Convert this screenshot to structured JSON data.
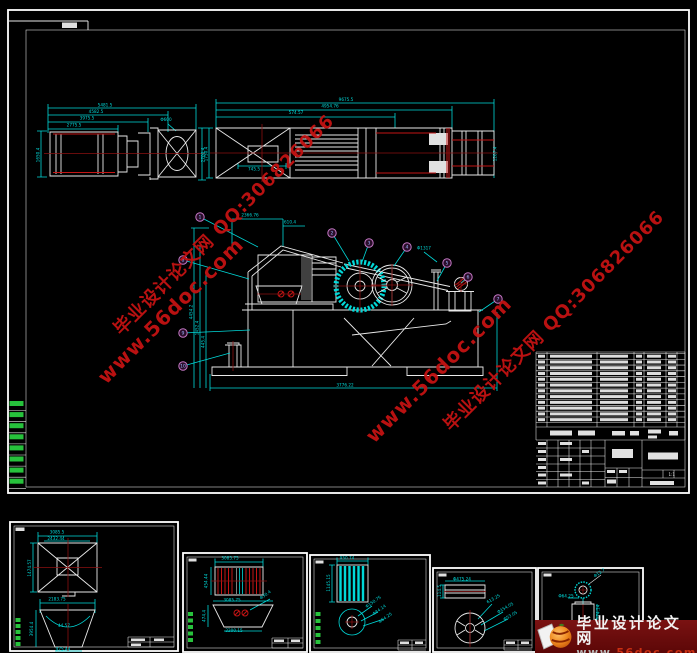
{
  "colors": {
    "cyan": "#00d9d9",
    "white": "#e9e9e9",
    "red": "#c41414",
    "dark_red": "#8a1010",
    "green": "#27c23c",
    "balloon": "#c678c6",
    "watermark": "#c31212",
    "logo_bg": "#6e0b0b",
    "logo_orange": "#e8791e"
  },
  "watermarks": {
    "line_zh_qq": "毕业设计论文网  QQ:306826066",
    "line_url": "www.56doc.com"
  },
  "logo": {
    "site_name": "毕业设计论文网",
    "url_www": "www.",
    "url_mid": "56doc",
    "url_dot": ".",
    "url_tld": "com"
  },
  "main_sheet": {
    "title_block": {
      "scale": "1:1"
    },
    "bom": {
      "rows": 12,
      "y0": 353.5,
      "step": 5.77,
      "cols": [
        {
          "x": 538,
          "w": 7
        },
        {
          "x": 550,
          "w": 42
        },
        {
          "x": 600,
          "w": 28
        },
        {
          "x": 636,
          "w": 6
        },
        {
          "x": 647,
          "w": 14
        },
        {
          "x": 668,
          "w": 8
        }
      ]
    },
    "balloons": [
      {
        "n": "1",
        "x": 200,
        "y": 217,
        "tx": 258,
        "ty": 247
      },
      {
        "n": "2",
        "x": 332,
        "y": 233,
        "tx": 349,
        "ty": 261
      },
      {
        "n": "3",
        "x": 369,
        "y": 243,
        "tx": 362,
        "ty": 262
      },
      {
        "n": "4",
        "x": 407,
        "y": 247,
        "tx": 394,
        "ty": 266
      },
      {
        "n": "5",
        "x": 447,
        "y": 263,
        "tx": 437,
        "ty": 281
      },
      {
        "n": "6",
        "x": 468,
        "y": 277,
        "tx": 461,
        "ty": 283
      },
      {
        "n": "7",
        "x": 498,
        "y": 299,
        "tx": 479,
        "ty": 312
      },
      {
        "n": "8",
        "x": 183,
        "y": 260,
        "tx": 249,
        "ty": 279
      },
      {
        "n": "9",
        "x": 183,
        "y": 333,
        "tx": 250,
        "ty": 330
      },
      {
        "n": "10",
        "x": 183,
        "y": 366,
        "tx": 230,
        "ty": 353
      }
    ]
  },
  "greens": [
    {
      "x": 9.5,
      "w": 14,
      "h": 5,
      "rows": 8,
      "y0": 401,
      "step": 11.1,
      "div": true,
      "dx1": 8,
      "dx2": 26
    },
    {
      "x": 15.5,
      "w": 5,
      "h": 4,
      "rows": 5,
      "y0": 618,
      "step": 6,
      "div": false
    },
    {
      "x": 188,
      "w": 5,
      "h": 4,
      "rows": 5,
      "y0": 612,
      "step": 6.5,
      "div": false
    },
    {
      "x": 315.5,
      "w": 5,
      "h": 4,
      "rows": 5,
      "y0": 612,
      "step": 7,
      "div": false
    }
  ],
  "dims": [
    {
      "t": "5481.5",
      "x": 105,
      "y": 106.5
    },
    {
      "t": "4582.5",
      "x": 96,
      "y": 113
    },
    {
      "t": "3975.5",
      "x": 87,
      "y": 119.5
    },
    {
      "t": "2775.5",
      "x": 74,
      "y": 126.5
    },
    {
      "t": "Φ600",
      "x": 166,
      "y": 121
    },
    {
      "t": "1650.4",
      "x": 39.5,
      "y": 155,
      "r": -90
    },
    {
      "t": "2700.4",
      "x": 204.5,
      "y": 155,
      "r": -90
    },
    {
      "t": "9675.5",
      "x": 346,
      "y": 101
    },
    {
      "t": "4954.76",
      "x": 330,
      "y": 107.5
    },
    {
      "t": "574.57",
      "x": 296,
      "y": 114
    },
    {
      "t": "745.5",
      "x": 254,
      "y": 170.5
    },
    {
      "t": "1750.4",
      "x": 207.5,
      "y": 154,
      "r": -90
    },
    {
      "t": "1207.4",
      "x": 496.5,
      "y": 154,
      "r": -90
    },
    {
      "t": "2366.76",
      "x": 250,
      "y": 216.5
    },
    {
      "t": "610.4",
      "x": 290,
      "y": 223.5
    },
    {
      "t": "Φ1317",
      "x": 424,
      "y": 249.5
    },
    {
      "t": "3776.22",
      "x": 345,
      "y": 386.5
    },
    {
      "t": "4454.2",
      "x": 192.5,
      "y": 312,
      "r": -90
    },
    {
      "t": "1452.4",
      "x": 198.5,
      "y": 328,
      "r": -90
    },
    {
      "t": "445.4",
      "x": 204.5,
      "y": 342,
      "r": -90
    },
    {
      "t": "3085.5",
      "x": 57,
      "y": 533.5
    },
    {
      "t": "2432.44",
      "x": 56,
      "y": 540
    },
    {
      "t": "1474.57",
      "x": 31,
      "y": 568,
      "r": -90
    },
    {
      "t": "2183.75",
      "x": 57,
      "y": 600.5
    },
    {
      "t": "44.57",
      "x": 64,
      "y": 627
    },
    {
      "t": "3954.4",
      "x": 33,
      "y": 629,
      "r": -90
    },
    {
      "t": "975.44",
      "x": 63,
      "y": 650.5
    },
    {
      "t": "3085.75",
      "x": 230,
      "y": 559.5
    },
    {
      "t": "454.44",
      "x": 207.5,
      "y": 581,
      "r": -90
    },
    {
      "t": "3085.75",
      "x": 232,
      "y": 601.5
    },
    {
      "t": "Φ30.4",
      "x": 266,
      "y": 596,
      "r": -35
    },
    {
      "t": "2200.15",
      "x": 234,
      "y": 632
    },
    {
      "t": "474.4",
      "x": 205.5,
      "y": 616,
      "r": -90
    },
    {
      "t": "950.74",
      "x": 347,
      "y": 559.5
    },
    {
      "t": "1145.15",
      "x": 330,
      "y": 583,
      "r": -90
    },
    {
      "t": "Φ150.75",
      "x": 374,
      "y": 603,
      "r": -35
    },
    {
      "t": "Φ84.14",
      "x": 380,
      "y": 611,
      "r": -35
    },
    {
      "t": "Φ64.25",
      "x": 386,
      "y": 619,
      "r": -35
    },
    {
      "t": "Φ475.24",
      "x": 462,
      "y": 580.5
    },
    {
      "t": "114.5",
      "x": 441,
      "y": 591,
      "r": -90
    },
    {
      "t": "613.25",
      "x": 494,
      "y": 600,
      "r": -30
    },
    {
      "t": "Φ154.05",
      "x": 506,
      "y": 609,
      "r": -30
    },
    {
      "t": "Φ53.05",
      "x": 511,
      "y": 617,
      "r": -30
    },
    {
      "t": "Φ12.7",
      "x": 600,
      "y": 574,
      "r": -35
    },
    {
      "t": "Φ64.25",
      "x": 566,
      "y": 597.5
    },
    {
      "t": "174.14",
      "x": 599.5,
      "y": 612,
      "r": -90
    }
  ]
}
